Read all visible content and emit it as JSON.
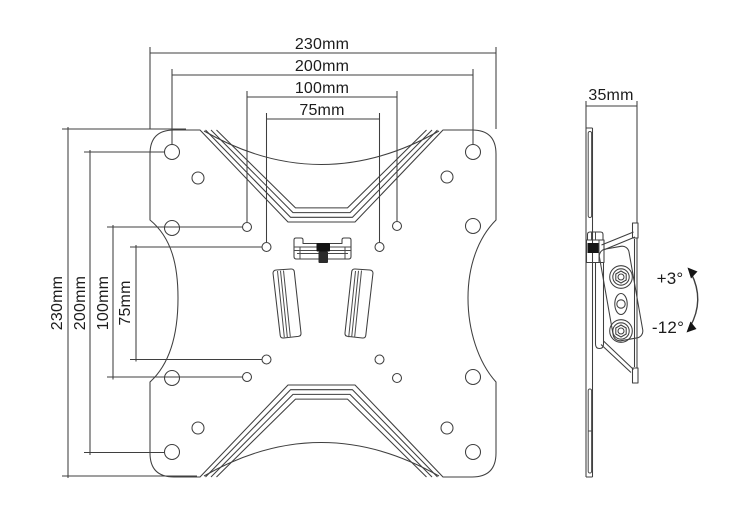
{
  "drawing": {
    "background": "#ffffff",
    "line_color": "#3f3f3f",
    "text_color": "#1c1c1c",
    "fill_black": "#141414"
  },
  "front_view": {
    "horizontal_dimensions": [
      "230mm",
      "200mm",
      "100mm",
      "75mm"
    ],
    "vertical_dimensions": [
      "230mm",
      "200mm",
      "100mm",
      "75mm"
    ]
  },
  "side_view": {
    "depth_dimension": "35mm",
    "tilt_up": "+3°",
    "tilt_down": "-12°"
  }
}
